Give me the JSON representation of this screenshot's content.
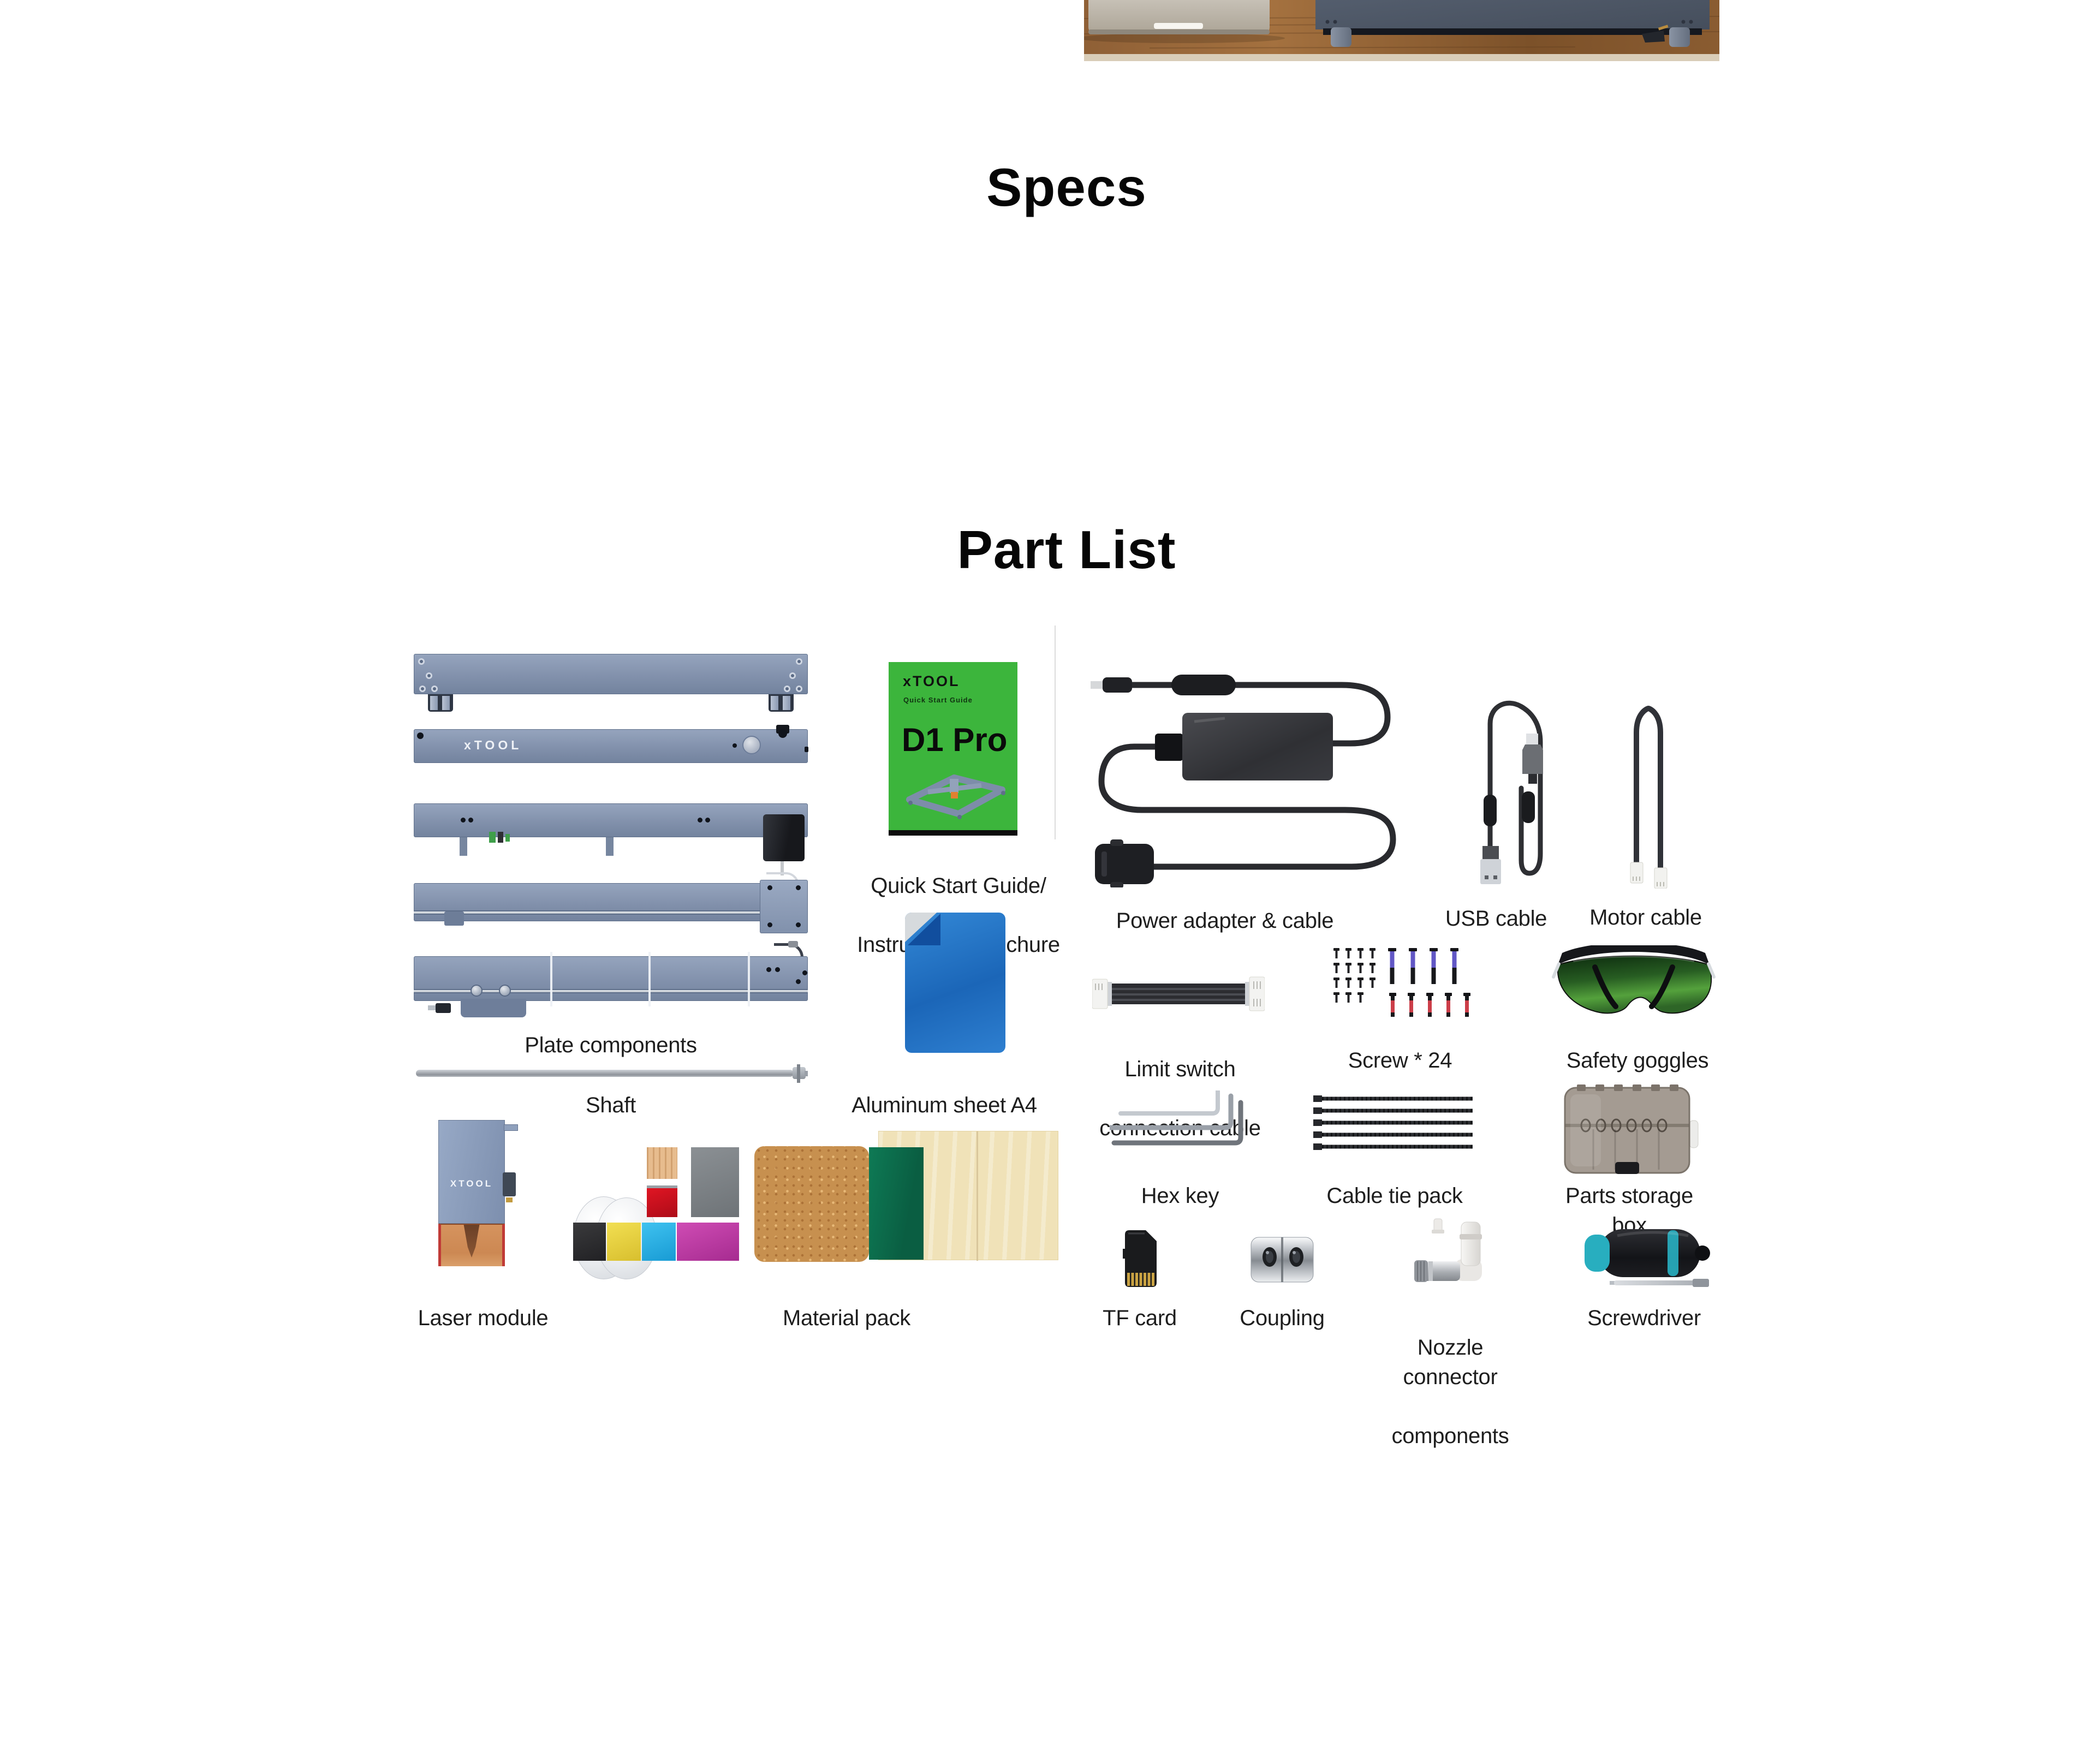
{
  "specs_section": {
    "title": "Specs"
  },
  "part_list_section": {
    "title": "Part List",
    "quick_start_book": {
      "brand": "xTOOL",
      "subtitle": "Quick Start Guide",
      "model": "D1 Pro"
    },
    "plate_logo": "xTOOL",
    "laser_module_logo": "XTOOL",
    "parts": {
      "plate_components": {
        "label": "Plate components"
      },
      "shaft": {
        "label": "Shaft"
      },
      "quick_start_guide": {
        "label_line1": "Quick Start Guide/",
        "label_line2": "Instructions/Brochure"
      },
      "aluminum_sheet": {
        "label": "Aluminum sheet A4"
      },
      "power_adapter": {
        "label": "Power adapter & cable"
      },
      "usb_cable": {
        "label": "USB cable"
      },
      "motor_cable": {
        "label": "Motor cable"
      },
      "limit_switch_cable": {
        "label_line1": "Limit switch",
        "label_line2": "connection cable"
      },
      "screws": {
        "label": "Screw * 24"
      },
      "safety_goggles": {
        "label": "Safety goggles"
      },
      "hex_key": {
        "label": "Hex key"
      },
      "cable_tie_pack": {
        "label": "Cable tie pack"
      },
      "parts_storage_box": {
        "label": "Parts storage box"
      },
      "laser_module": {
        "label": "Laser module"
      },
      "material_pack": {
        "label": "Material pack"
      },
      "tf_card": {
        "label": "TF card"
      },
      "coupling": {
        "label": "Coupling"
      },
      "nozzle_connector": {
        "label_line1": "Nozzle connector",
        "label_line2": "components"
      },
      "screwdriver": {
        "label": "Screwdriver"
      }
    },
    "colors": {
      "plate_blue_gray": "#8293ae",
      "book_green": "#3cb53c",
      "aluminum_blue": "#2374c8",
      "goggles_lens_green": "#3c8a30",
      "screw_band_purple": "#6257c5",
      "screw_band_red": "#cc3e49",
      "screwdriver_teal": "#28aebf",
      "cork": "#c7904f",
      "felt_green": "#0c6b4b",
      "plywood": "#f0e2b8",
      "desk_wood": "#8a5a33",
      "machine_gray": "#4d5665"
    }
  }
}
